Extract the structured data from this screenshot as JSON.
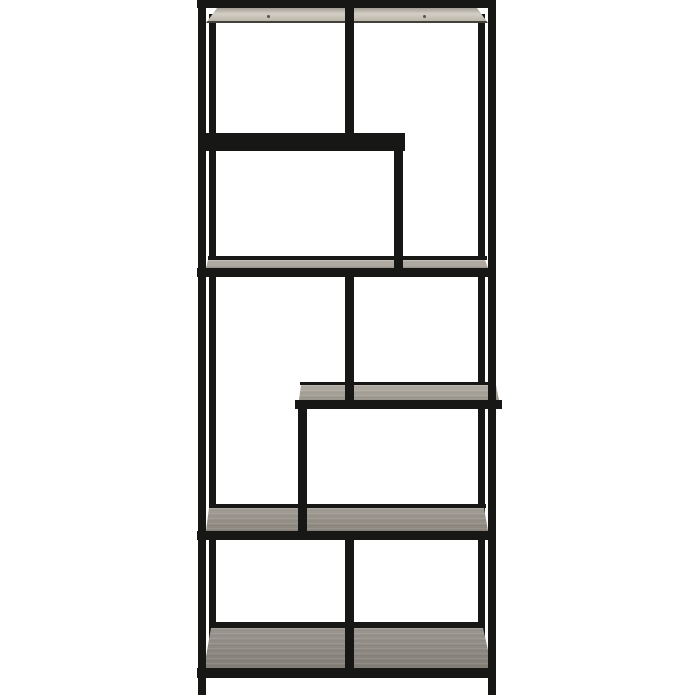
{
  "image": {
    "kind": "product-photo",
    "subject": "Tall black metal etagere shelving unit with staggered asymmetric shelves, photographed on a plain white background",
    "background": "#ffffff"
  },
  "structure": {
    "full_width_shelves": 4,
    "partial_shelves": 2,
    "layout_note": "top shelf; two-thirds-width shelf upper-left; full shelf; half-width shelf mid-right; full shelf; bottom shelf near floor"
  },
  "colors": {
    "frame": "#171716",
    "edge_shadow": "#44403a",
    "underside_light": "#c7c1b5",
    "sliver_light": "#eae7dd",
    "surface_upper": "#b3aea4",
    "surface_half": "#aca79d",
    "surface_lower": "#99938a",
    "surface_bottom": "#908b83",
    "screw": "#57524b"
  }
}
